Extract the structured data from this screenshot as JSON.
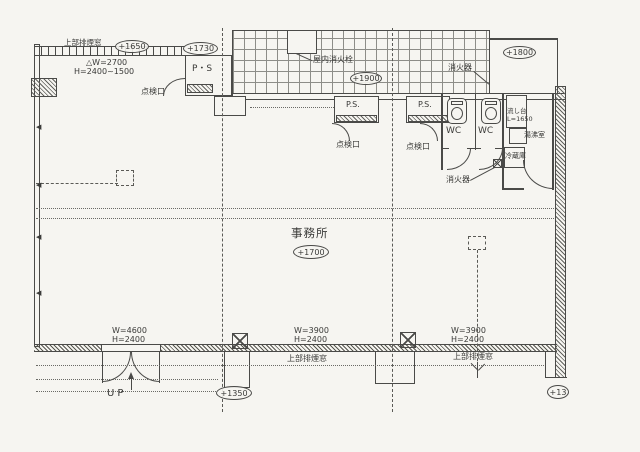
{
  "drawing": {
    "type": "architectural-floor-plan",
    "main_room": "事務所",
    "colors": {
      "ink": "#4a4a48",
      "paper": "#f6f5f1",
      "grid_line": "#8d8d88"
    }
  },
  "labels": {
    "smoke_vent_top": "上部排煙窓",
    "level_1650": "+1650",
    "level_1730": "+1730",
    "window_spec_w": "△W=2700",
    "window_spec_h": "H=2400~1500",
    "pipe_shaft_top": "P・S",
    "inspection_top": "点検口",
    "indoor_hydrant": "屋内消火栓",
    "level_1900": "+1900",
    "extinguisher_top": "消火器",
    "level_1800": "+1800",
    "pipe_shaft_left": "P.S.",
    "pipe_shaft_right": "P.S.",
    "inspection_left": "点検口",
    "inspection_right": "点検口",
    "wc_left": "WC",
    "wc_right": "WC",
    "sink_name": "流し台",
    "sink_length": "L=1650",
    "kitchenette": "湯沸室",
    "refrigerator": "冷蔵庫",
    "extinguisher_wc": "消火器",
    "office": "事務所",
    "level_1700": "+1700",
    "door_w": "W=4600",
    "door_h": "H=2400",
    "up": "UP",
    "level_1350": "+1350",
    "win1_w": "W=3900",
    "win1_h": "H=2400",
    "win1_name": "上部排煙窓",
    "win2_w": "W=3900",
    "win2_h": "H=2400",
    "win2_name": "上部排煙窓",
    "level_corner": "+13"
  }
}
